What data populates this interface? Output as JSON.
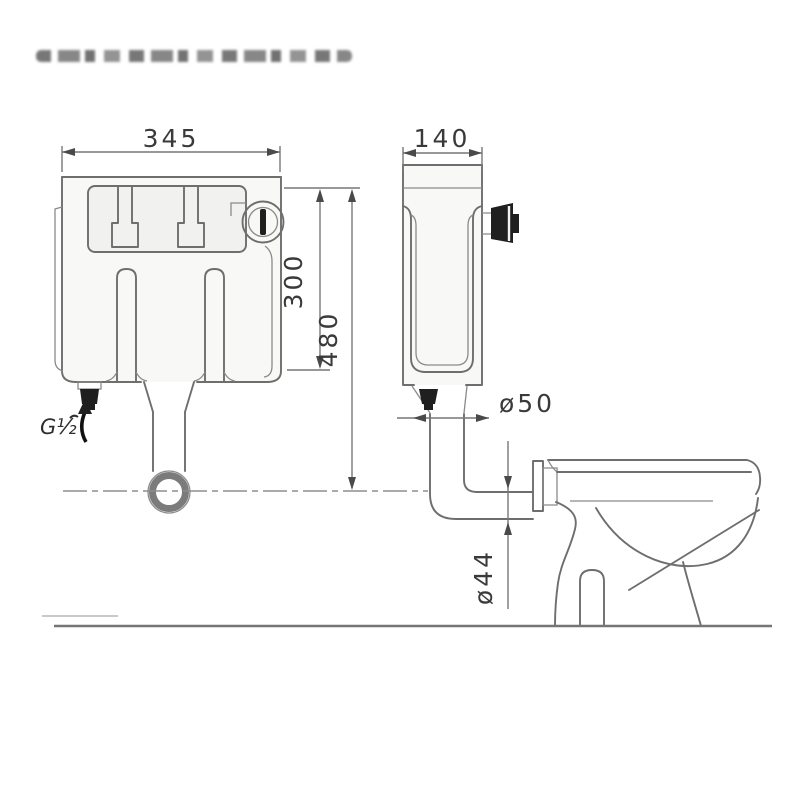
{
  "drawing": {
    "labels": {
      "front_width": "345",
      "side_depth": "140",
      "upper_height": "300",
      "total_height": "480",
      "flush_pipe_diameter": "ø50",
      "outlet_pipe_diameter": "ø44",
      "inlet_thread": "G½"
    },
    "colors": {
      "line": "#6e6e6e",
      "dark_fill": "#1f1f1f",
      "label_text": "#3a3a3a",
      "background": "#ffffff"
    }
  }
}
